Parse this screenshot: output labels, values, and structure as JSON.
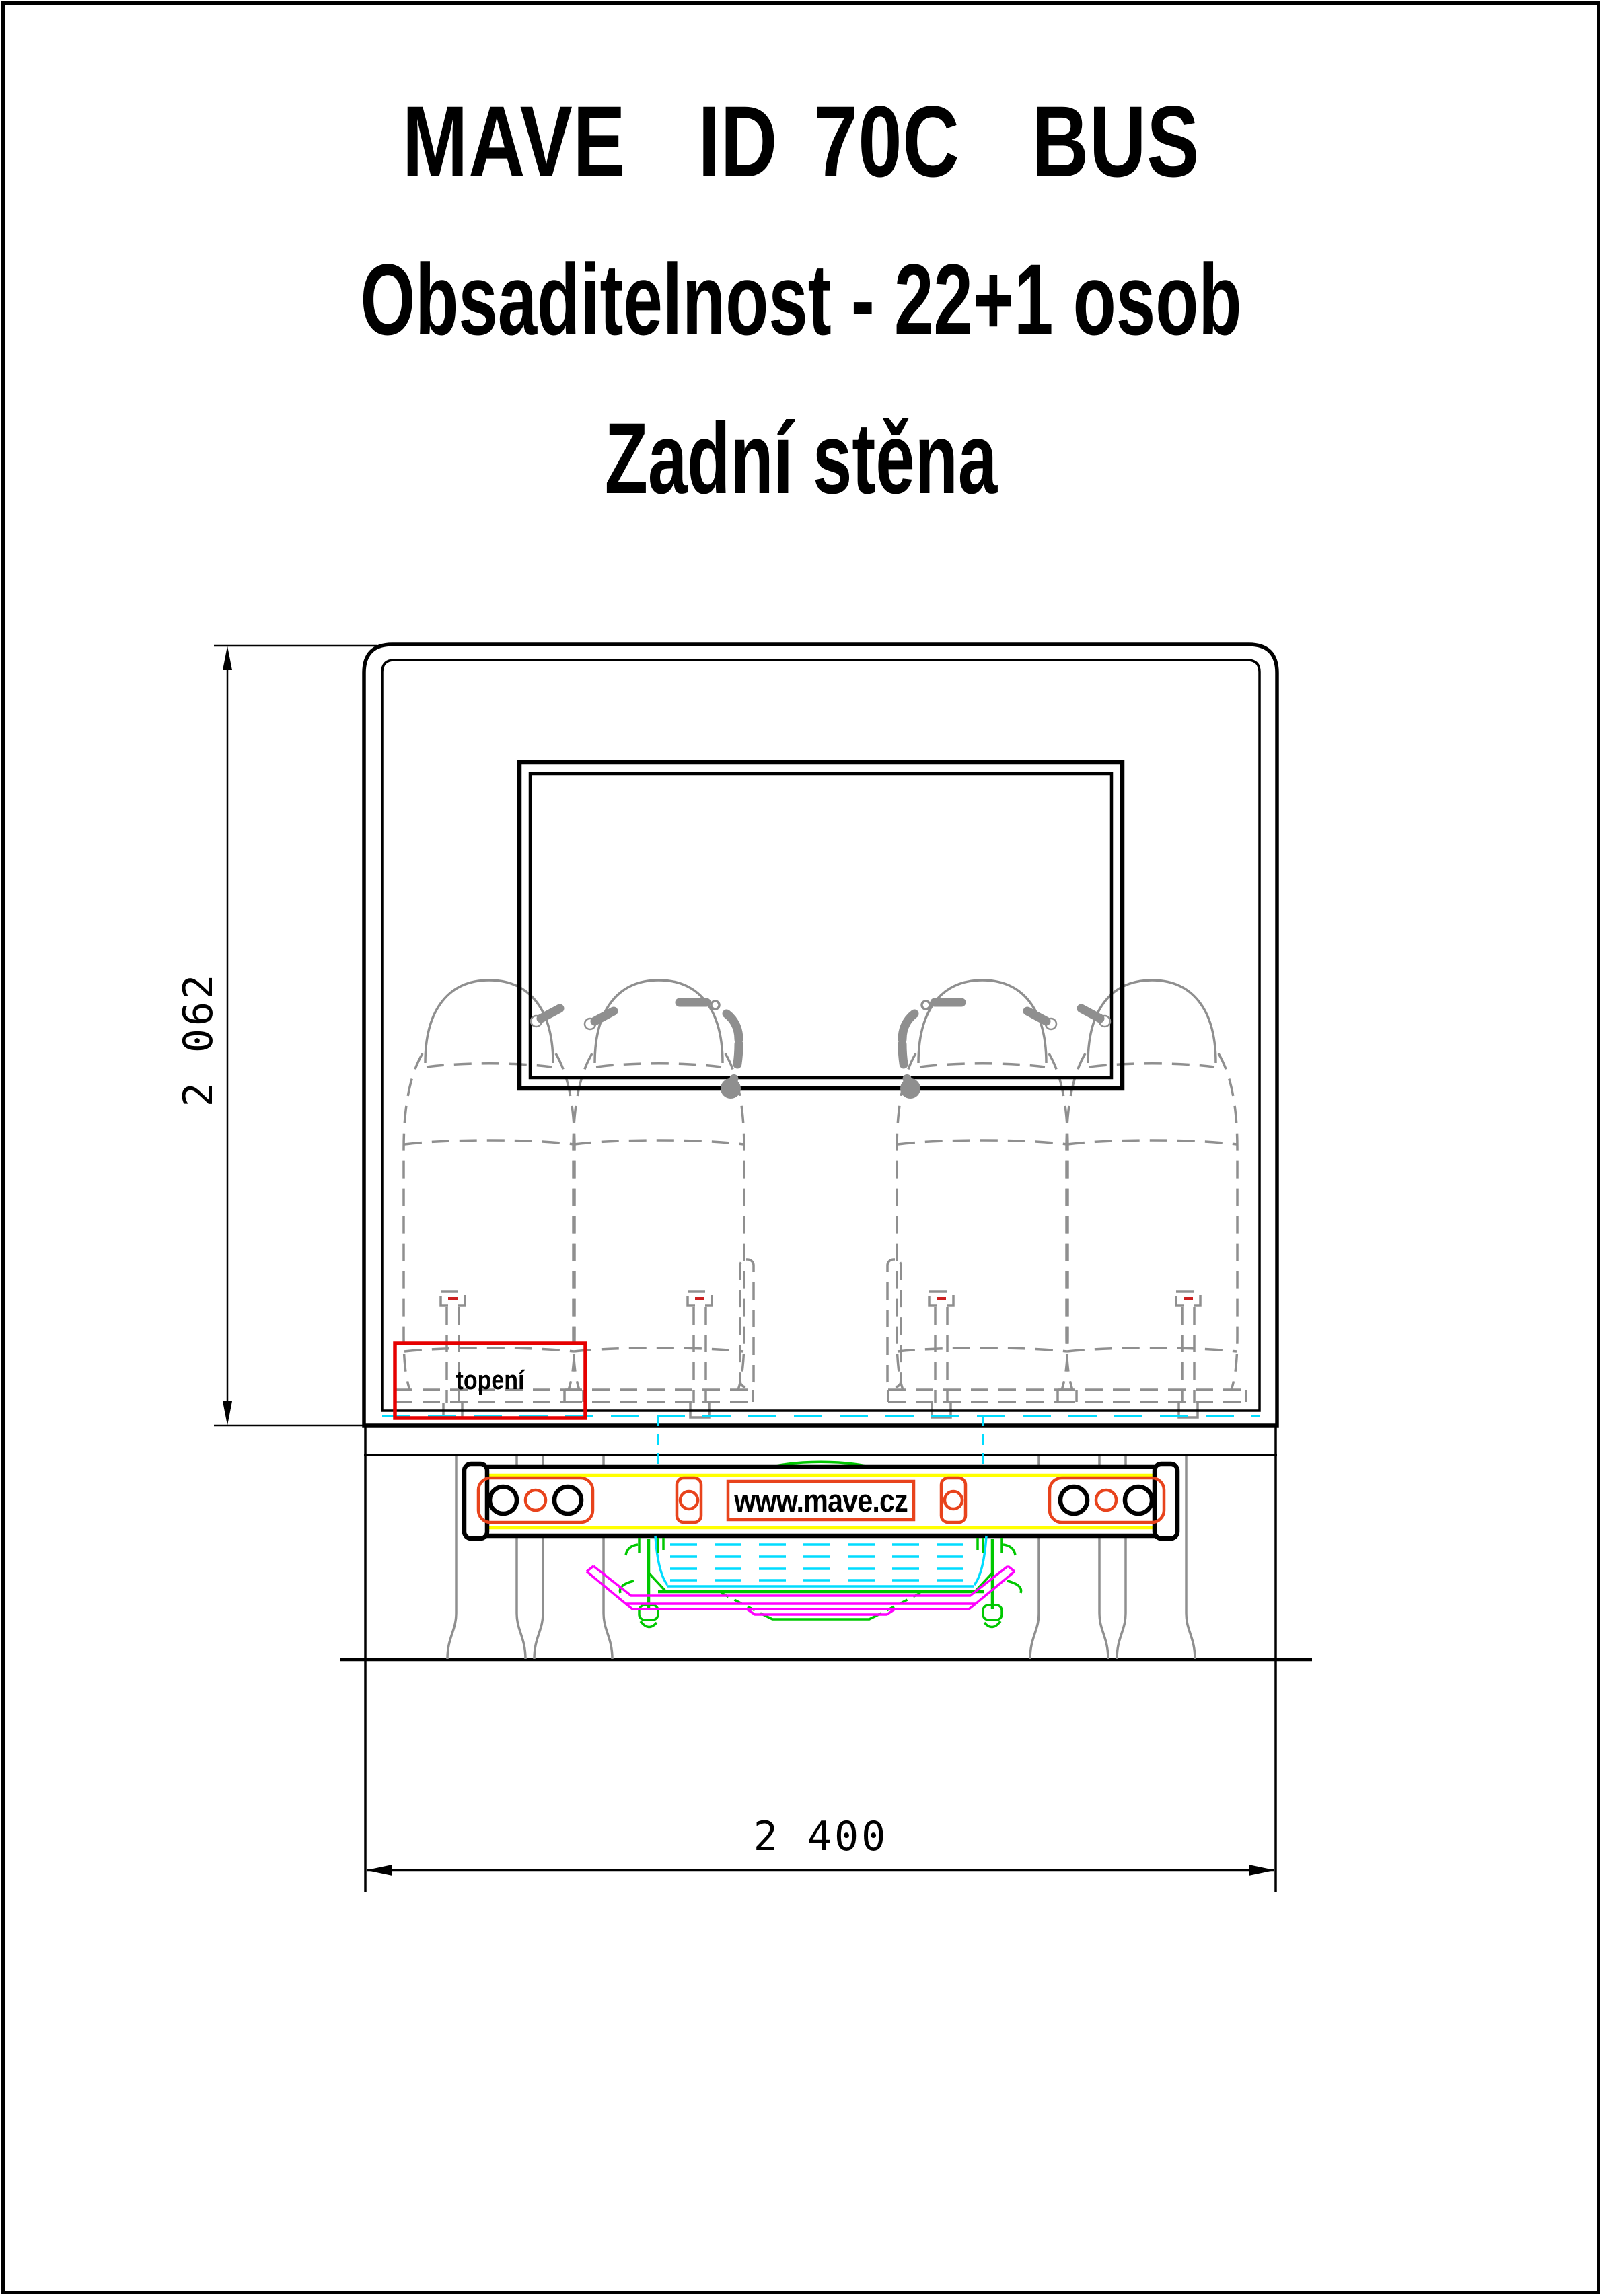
{
  "header": {
    "title": "MAVE  ID 70C  BUS",
    "subtitle": "Obsaditelnost - 22+1 osob",
    "view_title": "Zadní stěna"
  },
  "drawing": {
    "labels": {
      "heating": "topení",
      "bumper_url": "www.mave.cz"
    },
    "dimensions": {
      "height_mm": "2 062",
      "width_mm": "2 400"
    },
    "colors": {
      "line_black": "#000000",
      "seat_gray": "#8f8f8f",
      "lamp_orange": "#e8431c",
      "heating_box_red": "#e60000",
      "bumper_stripe_yellow": "#ffff00",
      "tank_cyan": "#00dcff",
      "mechanism_green": "#00c800",
      "towframe_magenta": "#ff00ff"
    }
  }
}
